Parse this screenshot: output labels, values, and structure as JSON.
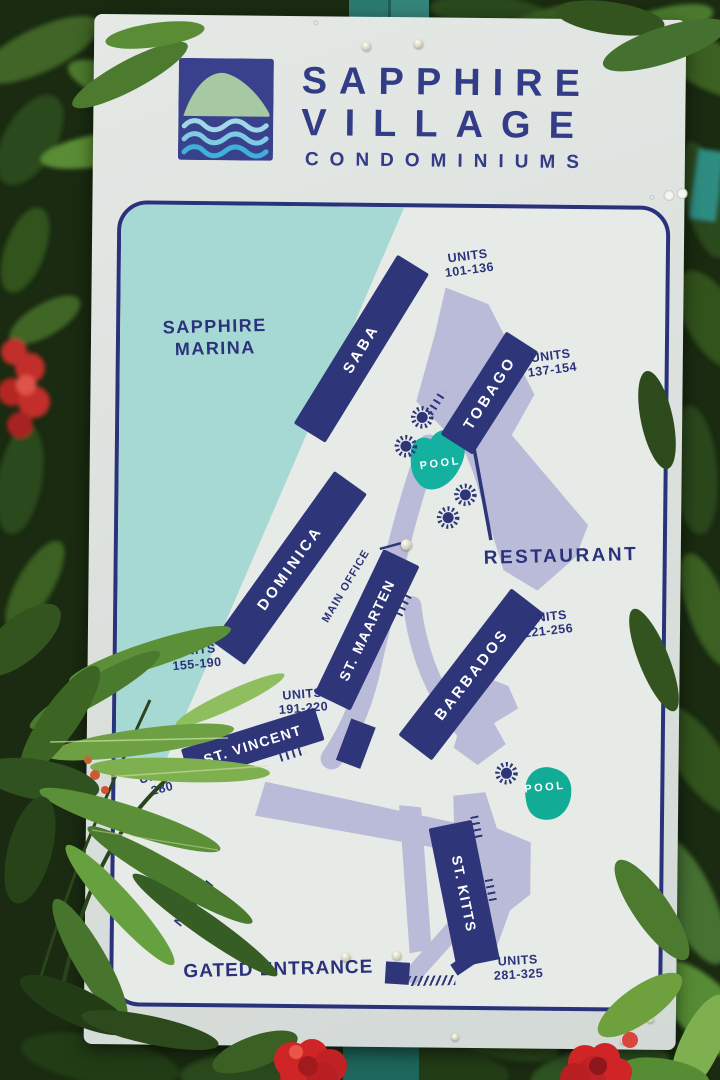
{
  "colors": {
    "navy": "#2e3579",
    "logo_navy": "#333c86",
    "water_teal": "#a7d9d4",
    "pool_teal": "#14b0a0",
    "road_lavender": "#b9bbd8",
    "sign_bg": "#dce1de",
    "post_teal": "#2c7b71",
    "leaf_green": "#5c9038",
    "flower_red": "#cf2527"
  },
  "icons": {
    "emblem": "hill-over-waves-icon",
    "tree": "starburst-tree-icon",
    "north": "north-arrow-icon"
  },
  "logo": {
    "title_line1": "SAPPHIRE",
    "title_line2": "VILLAGE",
    "subtitle": "CONDOMINIUMS"
  },
  "map": {
    "marina_line1": "SAPPHIRE",
    "marina_line2": "MARINA",
    "buildings": [
      {
        "name": "SABA",
        "units1": "UNITS",
        "units2": "101-136"
      },
      {
        "name": "TOBAGO",
        "units1": "UNITS",
        "units2": "137-154"
      },
      {
        "name": "DOMINICA",
        "units1": "UNITS",
        "units2": "155-190"
      },
      {
        "name": "ST. MAARTEN",
        "units1": "UNITS",
        "units2": "191-220"
      },
      {
        "name": "BARBADOS",
        "units1": "UNITS",
        "units2": "221-256"
      },
      {
        "name": "ST. VINCENT",
        "units1": "UNITS",
        "units2": "280"
      },
      {
        "name": "ST. KITTS",
        "units1": "UNITS",
        "units2": "281-325"
      }
    ],
    "labels": {
      "restaurant": "RESTAURANT",
      "main_office": "MAIN OFFICE",
      "pool": "POOL",
      "gated_entrance": "GATED ENTRANCE",
      "north": "NORTH"
    }
  }
}
